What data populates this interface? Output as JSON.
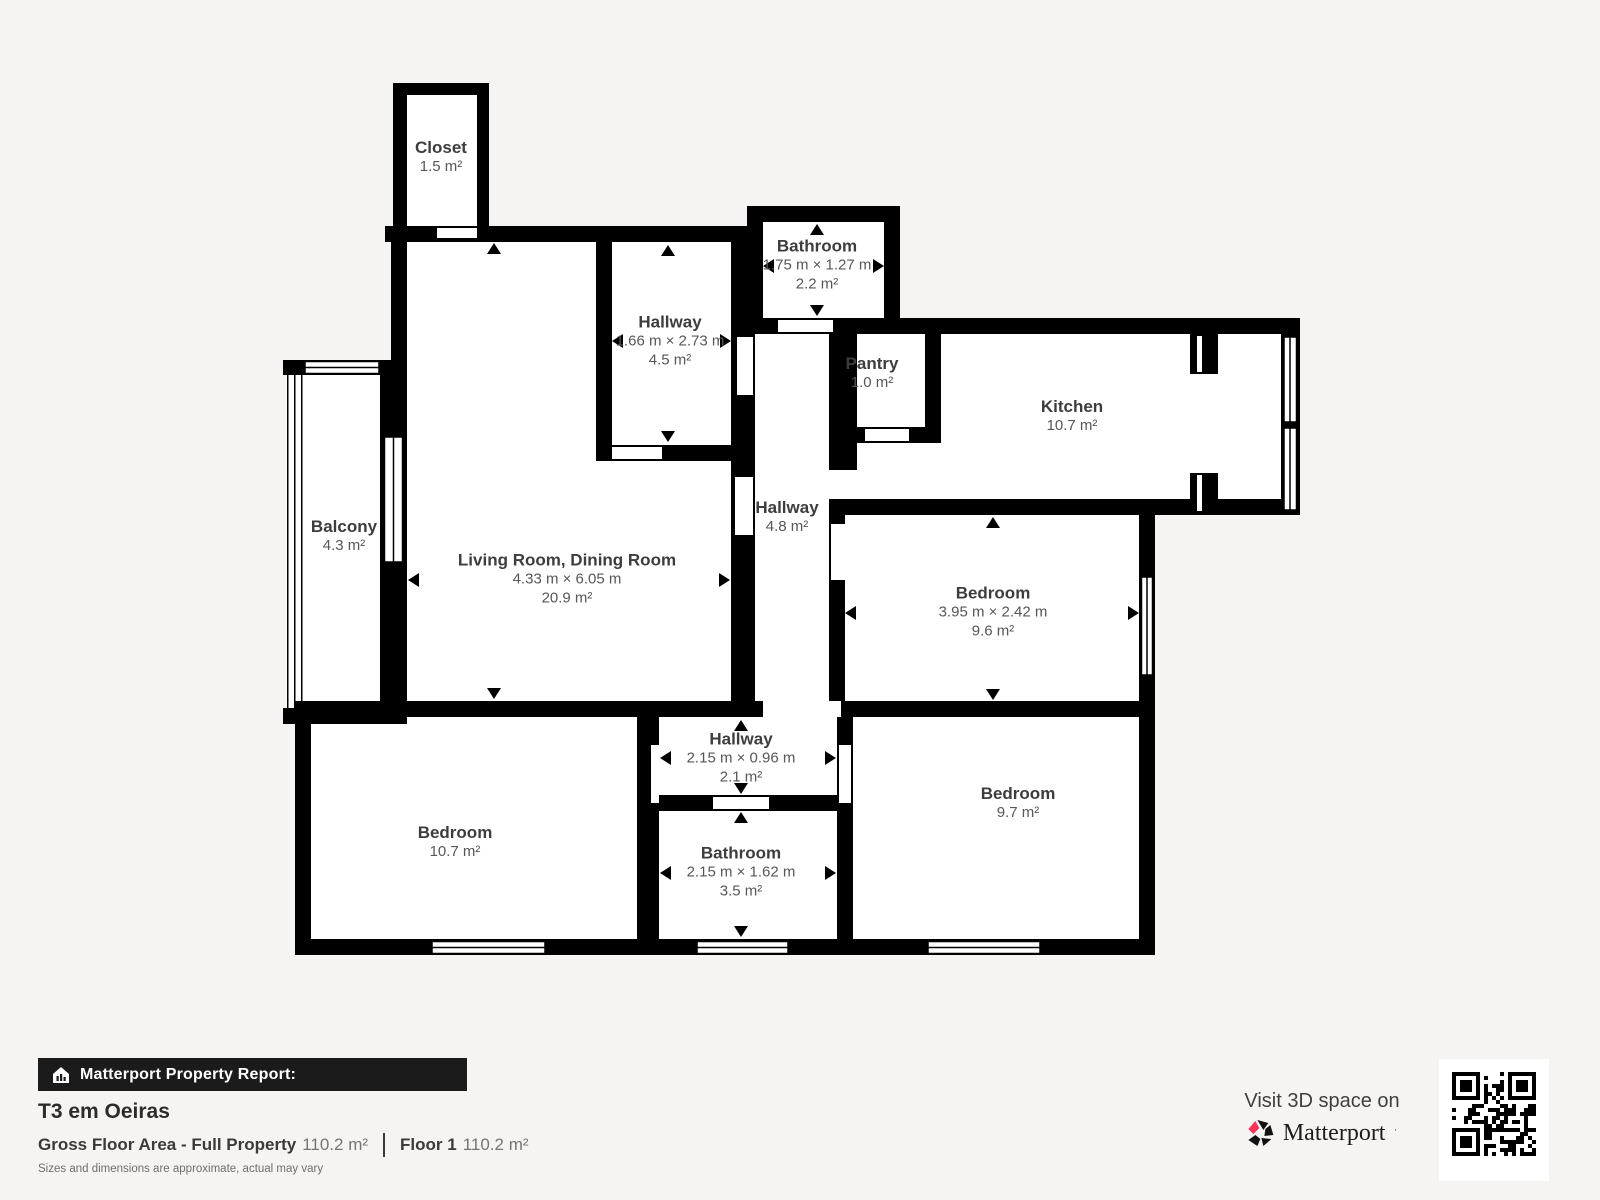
{
  "colors": {
    "background": "#f5f4f2",
    "wall": "#000000",
    "room_fill": "#ffffff",
    "label_text": "#3d3d3d",
    "sublabel_text": "#575757",
    "brand_red": "#ff3158",
    "bar_background": "#1b1b1b"
  },
  "rooms": [
    {
      "id": "closet",
      "name": "Closet",
      "area": "1.5 m²"
    },
    {
      "id": "bathroom-top",
      "name": "Bathroom",
      "dims": "1.75 m × 1.27 m",
      "area": "2.2 m²"
    },
    {
      "id": "hallway-upper",
      "name": "Hallway",
      "dims": "1.66 m × 2.73 m",
      "area": "4.5 m²"
    },
    {
      "id": "pantry",
      "name": "Pantry",
      "area": "1.0 m²"
    },
    {
      "id": "kitchen",
      "name": "Kitchen",
      "area": "10.7 m²"
    },
    {
      "id": "balcony",
      "name": "Balcony",
      "area": "4.3 m²"
    },
    {
      "id": "living-dining",
      "name": "Living Room, Dining Room",
      "dims": "4.33 m × 6.05 m",
      "area": "20.9 m²"
    },
    {
      "id": "hallway-mid",
      "name": "Hallway",
      "area": "4.8 m²"
    },
    {
      "id": "bedroom-east",
      "name": "Bedroom",
      "dims": "3.95 m × 2.42 m",
      "area": "9.6 m²"
    },
    {
      "id": "hallway-lower",
      "name": "Hallway",
      "dims": "2.15 m × 0.96 m",
      "area": "2.1 m²"
    },
    {
      "id": "bedroom-west",
      "name": "Bedroom",
      "area": "10.7 m²"
    },
    {
      "id": "bathroom-lower",
      "name": "Bathroom",
      "dims": "2.15 m × 1.62 m",
      "area": "3.5 m²"
    },
    {
      "id": "bedroom-south",
      "name": "Bedroom",
      "area": "9.7 m²"
    }
  ],
  "footer": {
    "report_label": "Matterport Property Report:",
    "title": "T3 em Oeiras",
    "gross_label": "Gross Floor Area - Full Property",
    "gross_value": "110.2 m²",
    "floor_label": "Floor 1",
    "floor_value": "110.2 m²",
    "disclaimer": "Sizes and dimensions are approximate, actual may vary",
    "visit_text": "Visit 3D space on",
    "brand": "Matterport"
  }
}
